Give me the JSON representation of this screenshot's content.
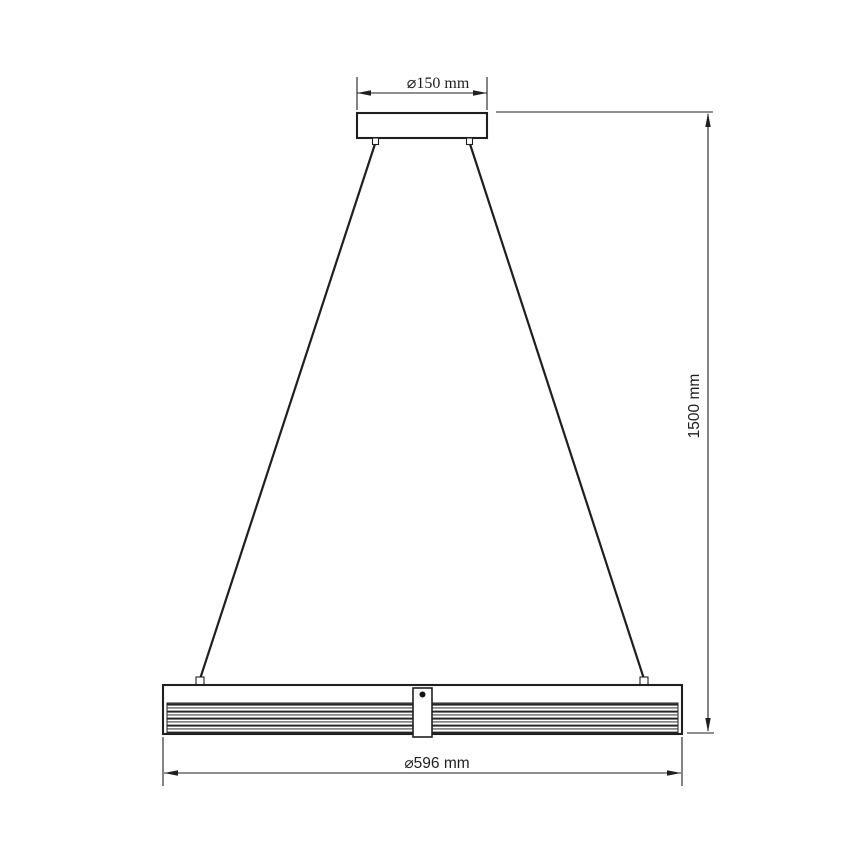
{
  "colors": {
    "line": "#1f1f1f",
    "background": "#ffffff"
  },
  "dimensions": {
    "canopy_diameter": "⌀150 mm",
    "drop_height": "1500 mm",
    "fixture_diameter": "⌀596 mm"
  }
}
